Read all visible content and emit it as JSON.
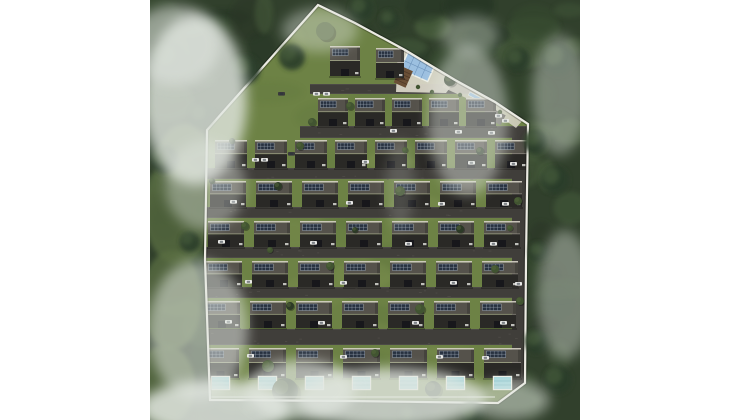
{
  "meta": {
    "description": "Aerial 3D site-plan rendering of a gated villa estate surrounded by forest and fog",
    "background": "#ffffff"
  },
  "scene": {
    "width": 430,
    "height": 420,
    "colors": {
      "forest_base": "#31402c",
      "forest_palette": [
        "#223121",
        "#2c3d29",
        "#36482f",
        "#405437",
        "#4a5f3c",
        "#2a3627"
      ],
      "meadow": "#5a6e43",
      "lawn": "#6d8245",
      "lawn_var": [
        "#798c4e",
        "#647a40",
        "#7f9251",
        "#5f763e"
      ],
      "road": "#403e3a",
      "road_speck": "#55524d",
      "curb": "#76736c",
      "boundary": "#ecebe3",
      "roof_trim": "#d6d2c6",
      "roof_top": "#55524b",
      "roof_mid": "#b9b4a8",
      "roof_face": "#2a2926",
      "porch": "#17171b",
      "panel": "#273140",
      "panel_line": "#97a1ad",
      "pool_water": "#a5d8de",
      "pool_lane": "#7fbcc4",
      "pool_frame": "#eef0e8",
      "amenity_pool": "#9cc0e0",
      "amenity_grid": "#6f95bc",
      "deck": "#d8d4c6",
      "pergola": "#6a4f36",
      "parking_pad": "#6e6b66",
      "car_white": "#e8e8e6",
      "car_dark": "#3a3a3c",
      "tree_dark": "#2c3a26",
      "tree_mid": "#415431",
      "tree_light": "#55683c",
      "fog": "#e3e8e2"
    },
    "site_polygon": "168,5 205,23 255,50 305,80 345,102 378,124 376,260 375,383 348,403 200,401 60,400 55,260 57,130",
    "bottom_path": {
      "x1": 60,
      "y1": 397,
      "x2": 345,
      "y2": 397
    },
    "meadows": [
      [
        28,
        210,
        34,
        55
      ],
      [
        22,
        300,
        30,
        50
      ],
      [
        35,
        152,
        25,
        28
      ],
      [
        15,
        385,
        30,
        40
      ]
    ],
    "roads": [
      {
        "x": 160,
        "y": 84,
        "w": 178,
        "h": 10
      },
      {
        "x": 150,
        "y": 126,
        "w": 228,
        "h": 12
      },
      {
        "x": 56,
        "y": 168,
        "w": 322,
        "h": 11
      },
      {
        "x": 55,
        "y": 207,
        "w": 323,
        "h": 11
      },
      {
        "x": 54,
        "y": 247,
        "w": 324,
        "h": 11
      },
      {
        "x": 53,
        "y": 287,
        "w": 325,
        "h": 11
      },
      {
        "x": 52,
        "y": 329,
        "w": 326,
        "h": 16
      },
      {
        "x": 362,
        "y": 126,
        "w": 16,
        "h": 264
      }
    ],
    "top_houses": [
      [
        180,
        46,
        30,
        30
      ],
      [
        226,
        48,
        28,
        30
      ]
    ],
    "rows": [
      {
        "y": 98,
        "h": 28,
        "x0": 168,
        "pitch": 37,
        "w": 30,
        "count": 5
      },
      {
        "y": 140,
        "h": 28,
        "x0": 65,
        "pitch": 40,
        "w": 32,
        "count": 8
      },
      {
        "y": 181,
        "h": 26,
        "x0": 60,
        "pitch": 46,
        "w": 36,
        "count": 7
      },
      {
        "y": 221,
        "h": 26,
        "x0": 58,
        "pitch": 46,
        "w": 36,
        "count": 7
      },
      {
        "y": 261,
        "h": 26,
        "x0": 56,
        "pitch": 46,
        "w": 36,
        "count": 7
      },
      {
        "y": 301,
        "h": 27,
        "x0": 54,
        "pitch": 46,
        "w": 36,
        "count": 7
      },
      {
        "y": 348,
        "h": 30,
        "x0": 52,
        "pitch": 47,
        "w": 37,
        "count": 7,
        "pools": {
          "y": 377,
          "w": 17,
          "h": 12
        }
      }
    ],
    "amenity": {
      "deck": "248,46 306,80 296,93 246,92",
      "walkway": "298,78 346,101 372,121 366,128 338,108 292,87",
      "pool": {
        "x": 258,
        "y": 52,
        "w": 30,
        "h": 19,
        "rot": 24
      },
      "pergola": {
        "x": 251,
        "y": 66,
        "w": 13,
        "h": 18,
        "rot": 24
      },
      "rill": {
        "x": 320,
        "y": 92,
        "w": 16,
        "h": 3.5,
        "rot": 28
      },
      "parking": {
        "x": 338,
        "y": 106,
        "w": 20,
        "h": 11,
        "rot": 28
      },
      "bushes": [
        [
          268,
          87
        ],
        [
          282,
          92
        ],
        [
          310,
          95
        ],
        [
          330,
          104
        ],
        [
          350,
          112
        ]
      ]
    },
    "cars": {
      "white": [
        [
          163,
          92
        ],
        [
          173,
          92
        ],
        [
          240,
          129
        ],
        [
          305,
          130
        ],
        [
          338,
          131
        ],
        [
          102,
          158
        ],
        [
          111,
          158
        ],
        [
          212,
          160
        ],
        [
          318,
          161
        ],
        [
          360,
          162
        ],
        [
          80,
          200
        ],
        [
          196,
          201
        ],
        [
          288,
          202
        ],
        [
          352,
          202
        ],
        [
          68,
          240
        ],
        [
          160,
          241
        ],
        [
          255,
          242
        ],
        [
          340,
          242
        ],
        [
          95,
          280
        ],
        [
          190,
          281
        ],
        [
          300,
          281
        ],
        [
          365,
          282
        ],
        [
          75,
          320
        ],
        [
          168,
          321
        ],
        [
          262,
          321
        ],
        [
          350,
          321
        ],
        [
          97,
          354
        ],
        [
          190,
          355
        ],
        [
          286,
          355
        ],
        [
          332,
          356
        ],
        [
          345,
          114
        ],
        [
          352,
          119
        ]
      ],
      "dark": [
        [
          138,
          152
        ],
        [
          128,
          92
        ]
      ]
    },
    "trees": [
      [
        135,
        391,
        13,
        "dark"
      ],
      [
        283,
        389,
        8,
        "dark"
      ],
      [
        118,
        366,
        6,
        "mid"
      ],
      [
        150,
        146,
        4,
        "mid"
      ],
      [
        128,
        186,
        4,
        "dark"
      ],
      [
        250,
        191,
        5,
        "mid"
      ],
      [
        95,
        226,
        4,
        "mid"
      ],
      [
        310,
        229,
        4,
        "dark"
      ],
      [
        180,
        266,
        4,
        "mid"
      ],
      [
        345,
        269,
        4,
        "mid"
      ],
      [
        140,
        306,
        4,
        "dark"
      ],
      [
        270,
        309,
        5,
        "mid"
      ],
      [
        225,
        353,
        4,
        "mid"
      ],
      [
        82,
        141,
        3,
        "dark"
      ],
      [
        200,
        106,
        4,
        "mid"
      ],
      [
        162,
        122,
        4,
        "mid"
      ],
      [
        330,
        151,
        4,
        "dark"
      ],
      [
        368,
        201,
        4,
        "mid"
      ],
      [
        370,
        301,
        4,
        "mid"
      ],
      [
        62,
        181,
        3,
        "dark"
      ],
      [
        175,
        31,
        9,
        "light"
      ],
      [
        300,
        80,
        6,
        "dark"
      ],
      [
        360,
        228,
        3,
        "mid"
      ],
      [
        205,
        230,
        3,
        "dark"
      ],
      [
        255,
        150,
        3,
        "mid"
      ],
      [
        120,
        250,
        3,
        "mid"
      ]
    ],
    "canopy": [
      [
        52,
        116,
        12
      ],
      [
        40,
        242,
        10
      ],
      [
        386,
        142,
        12
      ],
      [
        389,
        252,
        10
      ],
      [
        387,
        342,
        12
      ],
      [
        322,
        414,
        12
      ],
      [
        100,
        412,
        11
      ],
      [
        212,
        9,
        12
      ],
      [
        142,
        57,
        13
      ],
      [
        95,
        70,
        15
      ],
      [
        240,
        20,
        10
      ],
      [
        368,
        60,
        12
      ],
      [
        405,
        180,
        14
      ],
      [
        408,
        60,
        16
      ],
      [
        20,
        60,
        18
      ],
      [
        15,
        160,
        14
      ],
      [
        408,
        380,
        14
      ],
      [
        260,
        416,
        10
      ]
    ],
    "fog": [
      [
        45,
        100,
        52,
        85,
        0.8
      ],
      [
        25,
        45,
        45,
        40,
        0.55
      ],
      [
        55,
        185,
        40,
        45,
        0.4
      ],
      [
        48,
        330,
        50,
        70,
        0.55
      ],
      [
        65,
        408,
        75,
        28,
        0.85
      ],
      [
        170,
        30,
        38,
        22,
        0.4
      ],
      [
        320,
        35,
        30,
        20,
        0.35
      ],
      [
        318,
        120,
        40,
        75,
        0.45
      ],
      [
        410,
        95,
        28,
        60,
        0.4
      ],
      [
        415,
        295,
        28,
        65,
        0.4
      ],
      [
        240,
        398,
        95,
        30,
        0.8
      ],
      [
        150,
        390,
        55,
        30,
        0.7
      ],
      [
        250,
        185,
        14,
        45,
        0.18
      ],
      [
        360,
        400,
        40,
        20,
        0.5
      ]
    ]
  }
}
